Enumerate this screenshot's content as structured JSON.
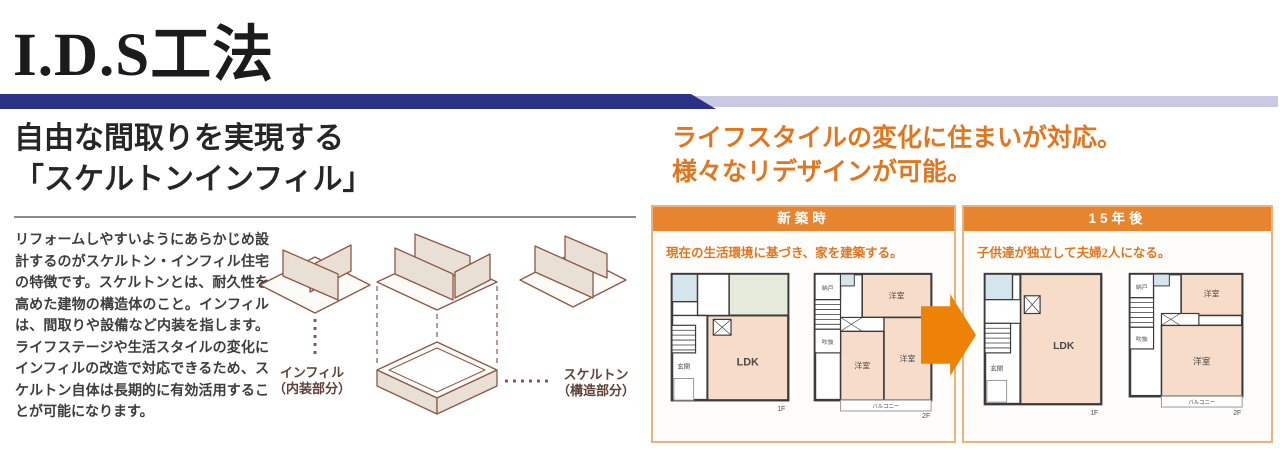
{
  "page": {
    "title": "I.D.S工法"
  },
  "left_section": {
    "heading_line1": "自由な間取りを実現する",
    "heading_line2": "「スケルトンインフィル」",
    "body_text": "リフォームしやすいようにあらかじめ設計するのがスケルトン・インフィル住宅の特徴です。スケルトンとは、耐久性を高めた建物の構造体のこと。インフィルは、間取りや設備など内装を指します。ライフステージや生活スタイルの変化にインフィルの改造で対応できるため、スケルトン自体は長期的に有効活用することが可能になります。"
  },
  "diagram": {
    "infill_label": "インフィル",
    "infill_sublabel": "（内装部分）",
    "skeleton_label": "スケルトン",
    "skeleton_sublabel": "（構造部分）"
  },
  "right_section": {
    "heading_line1": "ライフスタイルの変化に住まいが対応。",
    "heading_line2": "様々なリデザインが可能。",
    "panels": [
      {
        "header": "新築時",
        "description": "現在の生活環境に基づき、家を建築する。"
      },
      {
        "header": "15年後",
        "description": "子供達が独立して夫婦2人になる。"
      }
    ]
  },
  "floor_plans": {
    "shinchiku_1f": {
      "ldk": "LDK",
      "genkan": "玄関",
      "floor": "1F"
    },
    "shinchiku_2f": {
      "nando": "納戸",
      "fukinuke": "吹抜",
      "bedroom1": "洋室",
      "bedroom2": "洋室",
      "bedroom3": "洋室",
      "balcony": "バルコニー",
      "floor": "2F"
    },
    "after15_1f": {
      "ldk": "LDK",
      "genkan": "玄関",
      "floor": "1F"
    },
    "after15_2f": {
      "nando": "納戸",
      "fukinuke": "吹抜",
      "bedroom1": "洋室",
      "bedroom2": "洋室",
      "balcony": "バルコニー",
      "floor": "2F"
    }
  },
  "colors": {
    "navy_bar": "#2b3285",
    "lavender_bar": "#c9c9e3",
    "orange_accent": "#e0761f",
    "panel_header_bg": "#e8842e",
    "panel_border": "#ecb27c",
    "arrow": "#ee8206",
    "room_pink": "#f7ddc9",
    "room_blue": "#d4e5ee",
    "room_green": "#e4ebda",
    "diagram_line": "#8d5745"
  }
}
